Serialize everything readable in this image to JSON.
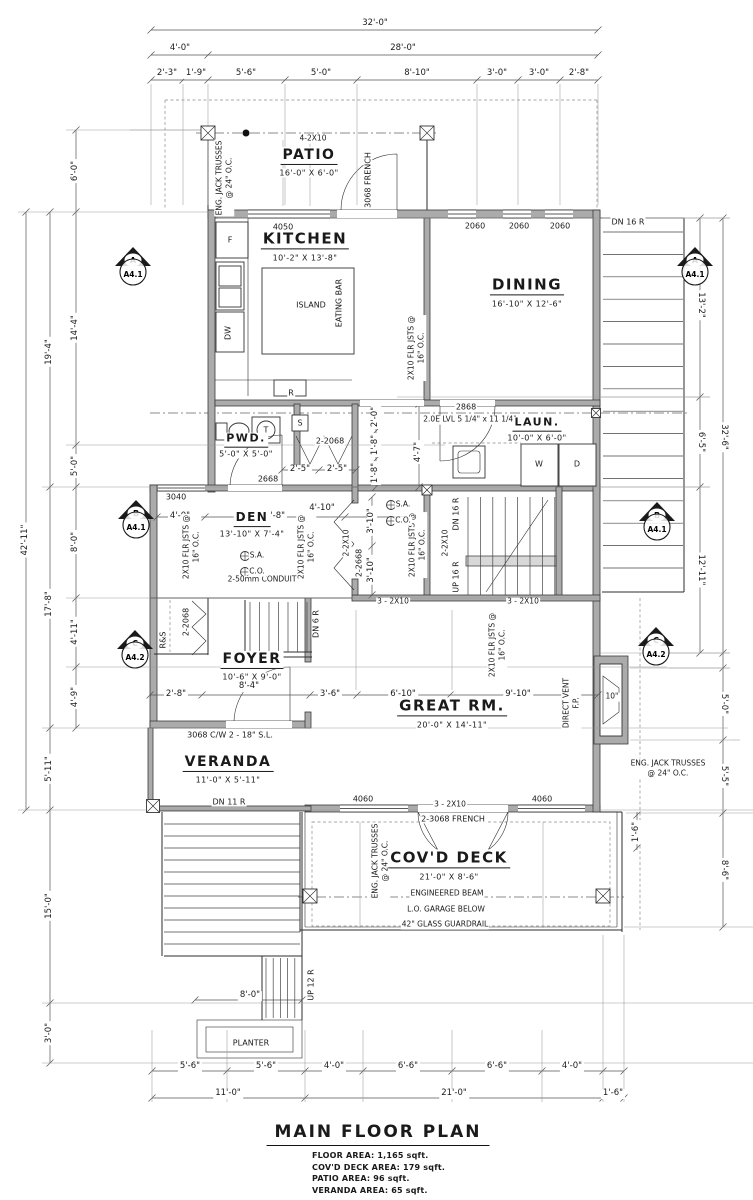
{
  "title_block": {
    "title": "MAIN FLOOR PLAN",
    "areas": [
      "FLOOR AREA: 1,165 sqft.",
      "COV'D DECK AREA: 179 sqft.",
      "PATIO AREA: 96 sqft.",
      "VERANDA AREA: 65 sqft."
    ]
  },
  "colors": {
    "wall_fill": "#ababab",
    "line": "#2e2e2e",
    "paper": "#ffffff"
  },
  "rooms": [
    {
      "name": "patio",
      "label": "PATIO",
      "dims": "16'-0\" X 6'-0\"",
      "x": 309,
      "y": 156,
      "fs": 14
    },
    {
      "name": "kitchen",
      "label": "KITCHEN",
      "dims": "10'-2\" X 13'-8\"",
      "x": 305,
      "y": 240,
      "fs": 15
    },
    {
      "name": "dining",
      "label": "DINING",
      "dims": "16'-10\" X 12'-6\"",
      "x": 527,
      "y": 286,
      "fs": 15
    },
    {
      "name": "laundry",
      "label": "LAUN.",
      "dims": "10'-0\" X 6'-0\"",
      "x": 537,
      "y": 424,
      "fs": 11
    },
    {
      "name": "powder",
      "label": "PWD.",
      "dims": "5'-0\" X 5'-0\"",
      "x": 246,
      "y": 440,
      "fs": 11
    },
    {
      "name": "den",
      "label": "DEN",
      "dims": "13'-10\" X 7'-4\"",
      "x": 252,
      "y": 519,
      "fs": 12
    },
    {
      "name": "foyer",
      "label": "FOYER",
      "dims": "10'-6\" X 9'-0\"",
      "x": 252,
      "y": 660,
      "fs": 14
    },
    {
      "name": "great-room",
      "label": "GREAT RM.",
      "dims": "20'-0\" X 14'-11\"",
      "x": 452,
      "y": 707,
      "fs": 15
    },
    {
      "name": "veranda",
      "label": "VERANDA",
      "dims": "11'-0\" X 5'-11\"",
      "x": 228,
      "y": 763,
      "fs": 14
    },
    {
      "name": "covd-deck",
      "label": "COV'D DECK",
      "dims": "21'-0\" X 8'-6\"",
      "x": 449,
      "y": 859,
      "fs": 15
    }
  ],
  "markers": [
    {
      "letter": "A",
      "sheet": "A4.1",
      "x": 113,
      "y": 246
    },
    {
      "letter": "A",
      "sheet": "A4.1",
      "x": 675,
      "y": 246
    },
    {
      "letter": "B",
      "sheet": "A4.1",
      "x": 116,
      "y": 499
    },
    {
      "letter": "B",
      "sheet": "A4.1",
      "x": 637,
      "y": 501
    },
    {
      "letter": "C",
      "sheet": "A4.2",
      "x": 115,
      "y": 629
    },
    {
      "letter": "C",
      "sheet": "A4.2",
      "x": 636,
      "y": 626
    }
  ],
  "labels": [
    {
      "t": "32'-0\"",
      "x": 375,
      "y": 24,
      "c": "d"
    },
    {
      "t": "4'-0\"",
      "x": 180,
      "y": 49,
      "c": "d"
    },
    {
      "t": "28'-0\"",
      "x": 403,
      "y": 49,
      "c": "d"
    },
    {
      "t": "2'-3\"",
      "x": 167,
      "y": 74,
      "c": "d"
    },
    {
      "t": "1'-9\"",
      "x": 196,
      "y": 74,
      "c": "d"
    },
    {
      "t": "5'-6\"",
      "x": 246,
      "y": 74,
      "c": "d"
    },
    {
      "t": "5'-0\"",
      "x": 321,
      "y": 74,
      "c": "d"
    },
    {
      "t": "8'-10\"",
      "x": 417,
      "y": 74,
      "c": "d"
    },
    {
      "t": "3'-0\"",
      "x": 497,
      "y": 74,
      "c": "d"
    },
    {
      "t": "3'-0\"",
      "x": 539,
      "y": 74,
      "c": "d"
    },
    {
      "t": "2'-8\"",
      "x": 579,
      "y": 74,
      "c": "d"
    },
    {
      "t": "42'-11\"",
      "x": 26,
      "y": 540,
      "c": "d",
      "r": -90
    },
    {
      "t": "19'-4\"",
      "x": 50,
      "y": 352,
      "c": "d",
      "r": -90
    },
    {
      "t": "17'-8\"",
      "x": 50,
      "y": 604,
      "c": "d",
      "r": -90
    },
    {
      "t": "5'-11\"",
      "x": 50,
      "y": 769,
      "c": "d",
      "r": -90
    },
    {
      "t": "15'-0\"",
      "x": 50,
      "y": 906,
      "c": "d",
      "r": -90
    },
    {
      "t": "3'-0\"",
      "x": 50,
      "y": 1033,
      "c": "d",
      "r": -90
    },
    {
      "t": "6'-0\"",
      "x": 76,
      "y": 171,
      "c": "d",
      "r": -90
    },
    {
      "t": "14'-4\"",
      "x": 76,
      "y": 328,
      "c": "d",
      "r": -90
    },
    {
      "t": "5'-0\"",
      "x": 76,
      "y": 466,
      "c": "d",
      "r": -90
    },
    {
      "t": "8'-0\"",
      "x": 76,
      "y": 542,
      "c": "d",
      "r": -90
    },
    {
      "t": "4'-11\"",
      "x": 76,
      "y": 632,
      "c": "d",
      "r": -90
    },
    {
      "t": "4'-9\"",
      "x": 76,
      "y": 697,
      "c": "d",
      "r": -90
    },
    {
      "t": "13'-2\"",
      "x": 700,
      "y": 305,
      "c": "d",
      "r": 90
    },
    {
      "t": "6'-5\"",
      "x": 700,
      "y": 442,
      "c": "d",
      "r": 90
    },
    {
      "t": "12'-11\"",
      "x": 700,
      "y": 570,
      "c": "d",
      "r": 90
    },
    {
      "t": "32'-6\"",
      "x": 723,
      "y": 437,
      "c": "d",
      "r": 90
    },
    {
      "t": "5'-0\"",
      "x": 723,
      "y": 704,
      "c": "d",
      "r": 90
    },
    {
      "t": "5'-5\"",
      "x": 723,
      "y": 776,
      "c": "d",
      "r": 90
    },
    {
      "t": "8'-6\"",
      "x": 723,
      "y": 870,
      "c": "d",
      "r": 90
    },
    {
      "t": "5'-6\"",
      "x": 190,
      "y": 1067,
      "c": "d"
    },
    {
      "t": "5'-6\"",
      "x": 266,
      "y": 1067,
      "c": "d"
    },
    {
      "t": "4'-0\"",
      "x": 334,
      "y": 1067,
      "c": "d"
    },
    {
      "t": "6'-6\"",
      "x": 408,
      "y": 1067,
      "c": "d"
    },
    {
      "t": "6'-6\"",
      "x": 497,
      "y": 1067,
      "c": "d"
    },
    {
      "t": "4'-0\"",
      "x": 572,
      "y": 1067,
      "c": "d"
    },
    {
      "t": "11'-0\"",
      "x": 228,
      "y": 1094,
      "c": "d"
    },
    {
      "t": "21'-0\"",
      "x": 454,
      "y": 1094,
      "c": "d"
    },
    {
      "t": "1'-6\"",
      "x": 613,
      "y": 1094,
      "c": "d"
    },
    {
      "t": "2'-8\"",
      "x": 176,
      "y": 695,
      "c": "d"
    },
    {
      "t": "3'-6\"",
      "x": 330,
      "y": 695,
      "c": "d"
    },
    {
      "t": "6'-10\"",
      "x": 403,
      "y": 695,
      "c": "d"
    },
    {
      "t": "9'-10\"",
      "x": 518,
      "y": 695,
      "c": "d"
    },
    {
      "t": "8'-4\"",
      "x": 249,
      "y": 687,
      "c": "d"
    },
    {
      "t": "4'-0\"",
      "x": 180,
      "y": 517,
      "c": "d"
    },
    {
      "t": "5'-8\"",
      "x": 275,
      "y": 517,
      "c": "d"
    },
    {
      "t": "4'-10\"",
      "x": 322,
      "y": 509,
      "c": "d"
    },
    {
      "t": "2'-5\"",
      "x": 300,
      "y": 470,
      "c": "d"
    },
    {
      "t": "2'-5\"",
      "x": 337,
      "y": 470,
      "c": "d"
    },
    {
      "t": "4'-7\"",
      "x": 419,
      "y": 452,
      "c": "d",
      "r": -90
    },
    {
      "t": "2'-0\"",
      "x": 376,
      "y": 417,
      "c": "d",
      "r": -90
    },
    {
      "t": "1'-8\"",
      "x": 376,
      "y": 445,
      "c": "d",
      "r": -90
    },
    {
      "t": "1'-8\"",
      "x": 376,
      "y": 473,
      "c": "d",
      "r": -90
    },
    {
      "t": "3'-10\"",
      "x": 372,
      "y": 521,
      "c": "d",
      "r": -90
    },
    {
      "t": "3'-10\"",
      "x": 372,
      "y": 570,
      "c": "d",
      "r": -90
    },
    {
      "t": "1'-6\"",
      "x": 637,
      "y": 832,
      "c": "d",
      "r": -90
    },
    {
      "t": "8'-0\"",
      "x": 250,
      "y": 996,
      "c": "d"
    },
    {
      "t": "4050",
      "x": 283,
      "y": 227,
      "c": "w"
    },
    {
      "t": "2060",
      "x": 475,
      "y": 226,
      "c": "w"
    },
    {
      "t": "2060",
      "x": 519,
      "y": 226,
      "c": "w"
    },
    {
      "t": "2060",
      "x": 560,
      "y": 226,
      "c": "w"
    },
    {
      "t": "3040",
      "x": 176,
      "y": 497,
      "c": "w"
    },
    {
      "t": "4060",
      "x": 363,
      "y": 799,
      "c": "w"
    },
    {
      "t": "4060",
      "x": 542,
      "y": 799,
      "c": "w"
    },
    {
      "t": "2868",
      "x": 466,
      "y": 407,
      "c": "w"
    },
    {
      "t": "2668",
      "x": 268,
      "y": 479,
      "c": "w"
    },
    {
      "t": "2-2068",
      "x": 330,
      "y": 441,
      "c": "w"
    },
    {
      "t": "2-2068",
      "x": 186,
      "y": 622,
      "c": "w",
      "r": -90
    },
    {
      "t": "2-2668",
      "x": 359,
      "y": 563,
      "c": "w",
      "r": -90
    },
    {
      "t": "3068 FRENCH",
      "x": 368,
      "y": 180,
      "c": "w",
      "r": -90
    },
    {
      "t": "2-3068 FRENCH",
      "x": 453,
      "y": 819,
      "c": "w"
    },
    {
      "t": "3068 C/W 2 - 18\" S.L.",
      "x": 230,
      "y": 735,
      "c": "w"
    },
    {
      "t": "R&S",
      "x": 163,
      "y": 640,
      "c": "w",
      "r": -90
    },
    {
      "t": "4-2X10",
      "x": 313,
      "y": 139,
      "c": "n"
    },
    {
      "t": "3 - 2X10",
      "x": 393,
      "y": 602,
      "c": "n"
    },
    {
      "t": "3 - 2X10",
      "x": 523,
      "y": 602,
      "c": "n"
    },
    {
      "t": "3 - 2X10",
      "x": 450,
      "y": 805,
      "c": "n"
    },
    {
      "t": "2-2X10",
      "x": 347,
      "y": 543,
      "c": "n",
      "r": -90
    },
    {
      "t": "2-2X10",
      "x": 446,
      "y": 543,
      "c": "n",
      "r": -90
    },
    {
      "t": "2.0E LVL 5 1/4\" x 11 1/4\"",
      "x": 470,
      "y": 420,
      "c": "n"
    },
    {
      "t": "ENG. JACK TRUSSES\n@ 24\" O.C.",
      "x": 224,
      "y": 178,
      "c": "n ml",
      "r": -90
    },
    {
      "t": "ENG. JACK TRUSSES\n@ 24\" O.C.",
      "x": 380,
      "y": 861,
      "c": "n ml",
      "r": -90
    },
    {
      "t": "ENG. JACK TRUSSES\n@ 24\" O.C.",
      "x": 668,
      "y": 768,
      "c": "n ml"
    },
    {
      "t": "2X10 FLR JSTS @\n16\" O.C.",
      "x": 416,
      "y": 348,
      "c": "n ml",
      "r": -90
    },
    {
      "t": "2X10 FLR JSTS @\n16\" O.C.",
      "x": 191,
      "y": 547,
      "c": "n ml",
      "r": -90
    },
    {
      "t": "2X10 FLR JSTS @\n16\" O.C.",
      "x": 306,
      "y": 547,
      "c": "n ml",
      "r": -90
    },
    {
      "t": "2X10 FLR JSTS @\n16\" O.C.",
      "x": 417,
      "y": 545,
      "c": "n ml",
      "r": -90
    },
    {
      "t": "2X10 FLR JSTS @\n16\" O.C.",
      "x": 497,
      "y": 645,
      "c": "n ml",
      "r": -90
    },
    {
      "t": "ENGINEERED BEAM",
      "x": 447,
      "y": 894,
      "c": "n"
    },
    {
      "t": "L.O. GARAGE BELOW",
      "x": 446,
      "y": 910,
      "c": "n"
    },
    {
      "t": "42\" GLASS GUARDRAIL",
      "x": 445,
      "y": 925,
      "c": "n"
    },
    {
      "t": "2-50mm CONDUIT",
      "x": 262,
      "y": 580,
      "c": "n"
    },
    {
      "t": "DIRECT VENT\nF.P.",
      "x": 571,
      "y": 703,
      "c": "n ml",
      "r": -90
    },
    {
      "t": "10\"",
      "x": 612,
      "y": 697,
      "c": "n"
    },
    {
      "t": "DN 16 R",
      "x": 628,
      "y": 222,
      "c": "w"
    },
    {
      "t": "DN 16 R",
      "x": 456,
      "y": 514,
      "c": "w",
      "r": -90
    },
    {
      "t": "UP 16 R",
      "x": 456,
      "y": 577,
      "c": "w",
      "r": -90
    },
    {
      "t": "DN 6 R",
      "x": 316,
      "y": 624,
      "c": "w",
      "r": -90
    },
    {
      "t": "DN 11 R",
      "x": 229,
      "y": 802,
      "c": "w"
    },
    {
      "t": "UP 12 R",
      "x": 311,
      "y": 985,
      "c": "w",
      "r": -90
    },
    {
      "t": "PLANTER",
      "x": 251,
      "y": 1043,
      "c": "w"
    },
    {
      "t": "F",
      "x": 230,
      "y": 240,
      "c": "w"
    },
    {
      "t": "DW",
      "x": 228,
      "y": 333,
      "c": "w",
      "r": -90
    },
    {
      "t": "R",
      "x": 291,
      "y": 393,
      "c": "w"
    },
    {
      "t": "S",
      "x": 300,
      "y": 423,
      "c": "w"
    },
    {
      "t": "T",
      "x": 266,
      "y": 430,
      "c": "w"
    },
    {
      "t": "W",
      "x": 539,
      "y": 464,
      "c": "w"
    },
    {
      "t": "D",
      "x": 577,
      "y": 464,
      "c": "w"
    },
    {
      "t": "ISLAND",
      "x": 311,
      "y": 305,
      "c": "w"
    },
    {
      "t": "EATING BAR",
      "x": 339,
      "y": 303,
      "c": "w",
      "r": -90
    },
    {
      "t": "S.A.",
      "x": 257,
      "y": 556,
      "c": "n"
    },
    {
      "t": "C.O.",
      "x": 257,
      "y": 572,
      "c": "n"
    },
    {
      "t": "S.A.",
      "x": 403,
      "y": 505,
      "c": "n"
    },
    {
      "t": "C.O.",
      "x": 403,
      "y": 521,
      "c": "n"
    }
  ]
}
